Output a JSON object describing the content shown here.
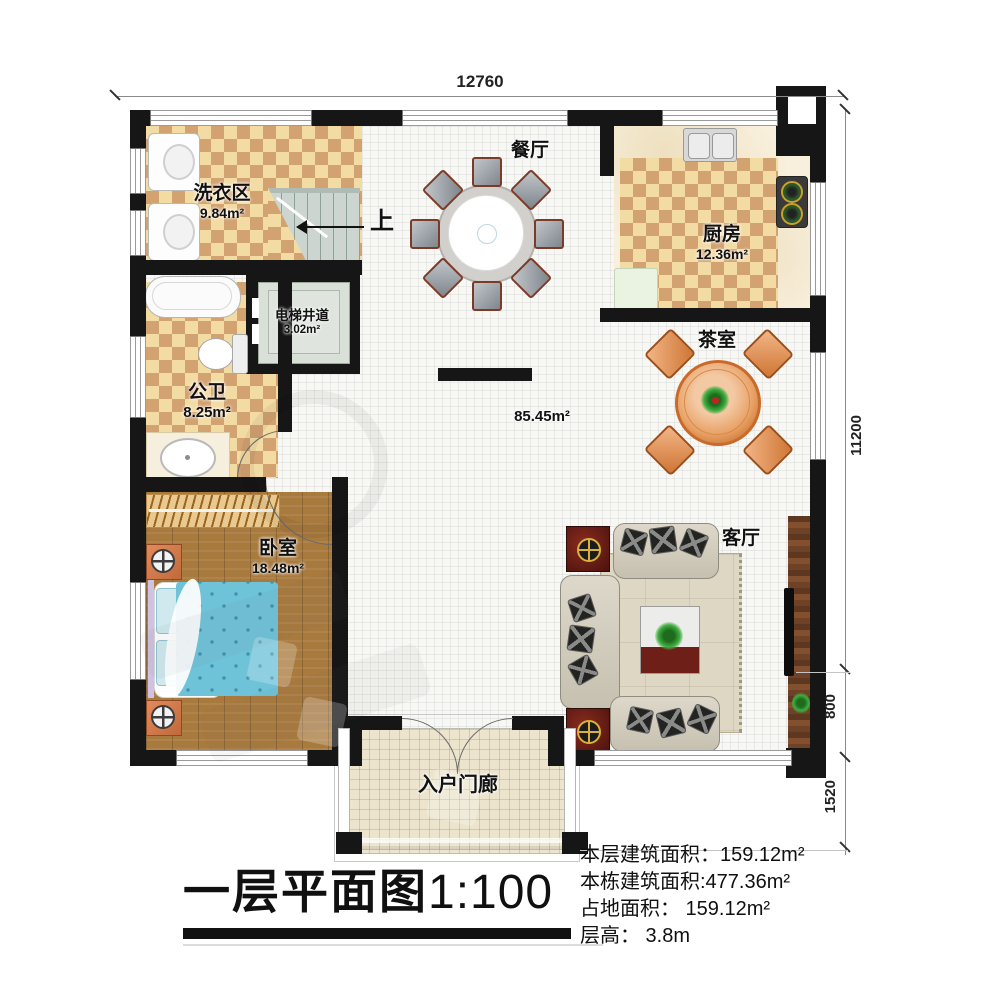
{
  "title": {
    "main": "一层平面图",
    "scale": "1:100"
  },
  "dimensions": {
    "top_width": "12760",
    "right_height": "11200",
    "right_living": "800",
    "right_porch": "1520"
  },
  "rooms": {
    "laundry": {
      "name": "洗衣区",
      "area": "9.84m²"
    },
    "dining": {
      "name": "餐厅"
    },
    "kitchen": {
      "name": "厨房",
      "area": "12.36m²"
    },
    "elevator": {
      "name": "电梯井道",
      "area": "3.02m²"
    },
    "bathroom": {
      "name": "公卫",
      "area": "8.25m²"
    },
    "tea_room": {
      "name": "茶室"
    },
    "hall": {
      "area": "85.45m²"
    },
    "bedroom": {
      "name": "卧室",
      "area": "18.48m²"
    },
    "living": {
      "name": "客厅"
    },
    "porch": {
      "name": "入户门廊"
    }
  },
  "stairs": {
    "up_label": "上"
  },
  "info": {
    "lines": [
      "本层建筑面积：159.12m²",
      "本栋建筑面积:477.36m²",
      "占地面积： 159.12m²",
      "层高： 3.8m"
    ]
  },
  "colors": {
    "wall": "#161616",
    "tile_light": "#f3dba4",
    "tile_dark": "#d2a271",
    "wood_floor": "#a97a3e",
    "bed_blue": "#6fc3d9",
    "dark_wood": "#6e4226",
    "rug": "#ded7c3"
  }
}
